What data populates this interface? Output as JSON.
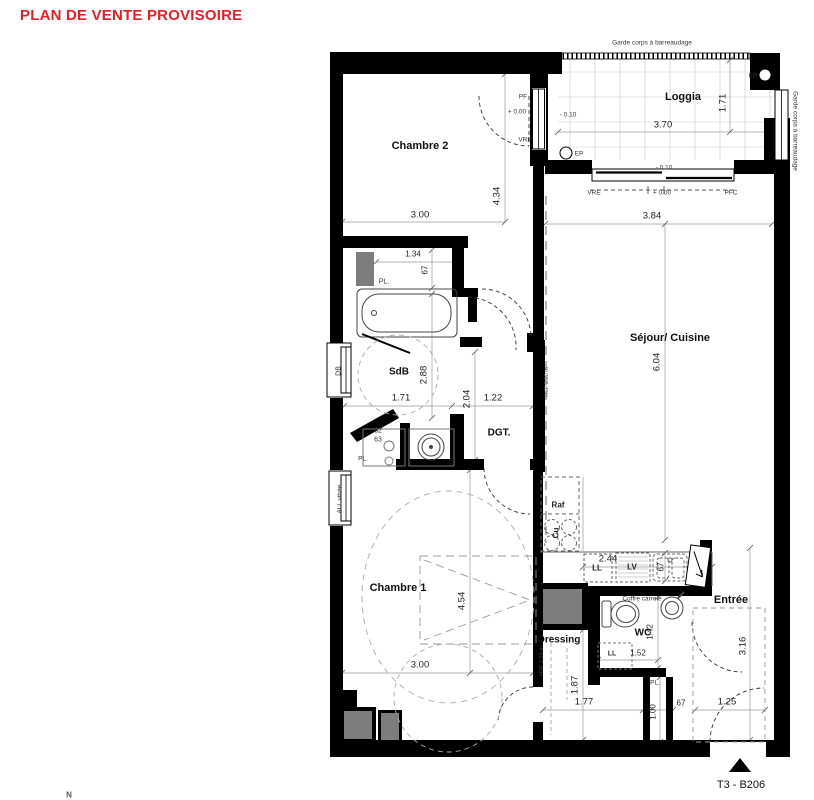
{
  "title": "PLAN DE VENTE PROVISOIRE",
  "unit_label": "T3 - B206",
  "north_label": "N",
  "rooms": {
    "chambre2": "Chambre 2",
    "loggia": "Loggia",
    "sejour_cuisine": "Séjour/ Cuisine",
    "sdb": "SdB",
    "dgt": "DGT.",
    "chambre1": "Chambre 1",
    "dressing": "Dressing",
    "wc": "WC",
    "entree": "Entrée"
  },
  "dims": {
    "chambre2_w": "3.00",
    "chambre2_h": "4.34",
    "loggia_w": "3.70",
    "loggia_h": "1.71",
    "sejour_w": "3.84",
    "sejour_h": "6.04",
    "closet_w": "1.34",
    "closet_d": "67",
    "sdb_w": "1.71",
    "sdb_h": "2.88",
    "dgt_w": "1.22",
    "dgt_h": "2.04",
    "cupboard_w": "62",
    "cupboard_d": "63",
    "kitchen_w": "2.44",
    "kitchen_d": "67",
    "chambre1_w": "3.00",
    "chambre1_h": "4.54",
    "dressing_w": "1.77",
    "dressing_h": "1.87",
    "wc_w": "1.52",
    "wc_h": "1.42",
    "hall_l": "1.00",
    "hall_w": "67",
    "entree_w": "1.25",
    "entree_h": "3.16"
  },
  "levels": {
    "zero": "+ 0.00",
    "minus": "- 0.10"
  },
  "annotations": {
    "garde_corps": "Garde corps à barreaudage",
    "pf": "PF",
    "vre": "VRE",
    "pfc": "PFC",
    "ep": "EP",
    "db": "DB",
    "all_vitree": "ALL vitrée",
    "pl": "PL.",
    "raf": "Raf",
    "cu": "Cu",
    "ll": "LL",
    "lv": "LV",
    "coffre": "Coffre carrelé",
    "hsp": "HSP 2.20 m"
  },
  "colors": {
    "accent_red": "#ee1b23",
    "wall": "#000000",
    "shaft": "#7d7d7d",
    "dim_line": "#888888"
  }
}
